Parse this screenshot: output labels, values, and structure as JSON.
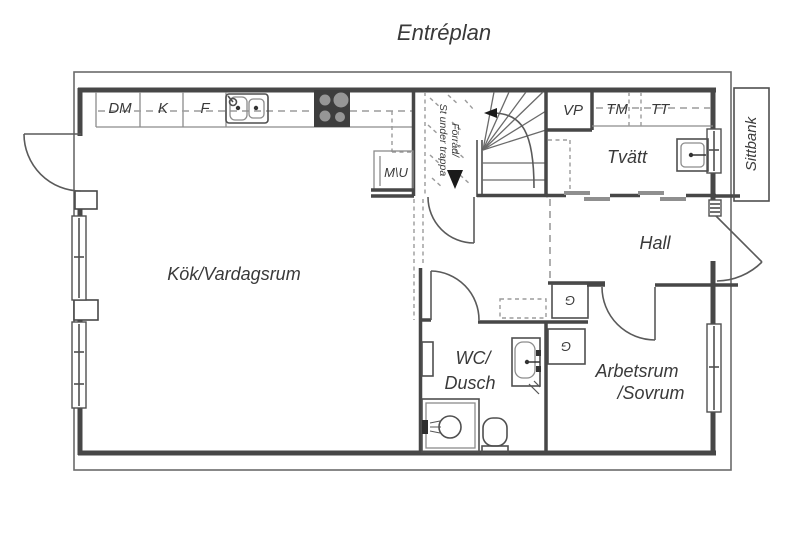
{
  "title": "Entréplan",
  "floor_plan": {
    "rooms": {
      "kitchen_living": "Kök/Vardagsrum",
      "wc_line1": "WC/",
      "wc_line2": "Dusch",
      "workroom_line1": "Arbetsrum",
      "workroom_line2": "/Sovrum",
      "hall": "Hall",
      "laundry": "Tvätt"
    },
    "appliances": {
      "dishwasher": "DM",
      "fridge": "K",
      "freezer": "F",
      "heat_pump": "VP",
      "washing_machine": "TM",
      "dryer": "TT",
      "micro_oven": "M\\U"
    },
    "storage": {
      "under_stairs_line1": "Förråd/",
      "under_stairs_line2": "St under trappa",
      "wardrobe1": "G",
      "wardrobe2": "G"
    },
    "outdoor": {
      "bench": "Sittbank"
    },
    "colors": {
      "wall": "#474747",
      "thin_line": "#8c8c8c",
      "dashed_line": "#9b9b9b",
      "text": "#3a3a3a",
      "stove": "#3d3d3d",
      "background": "#ffffff"
    }
  }
}
